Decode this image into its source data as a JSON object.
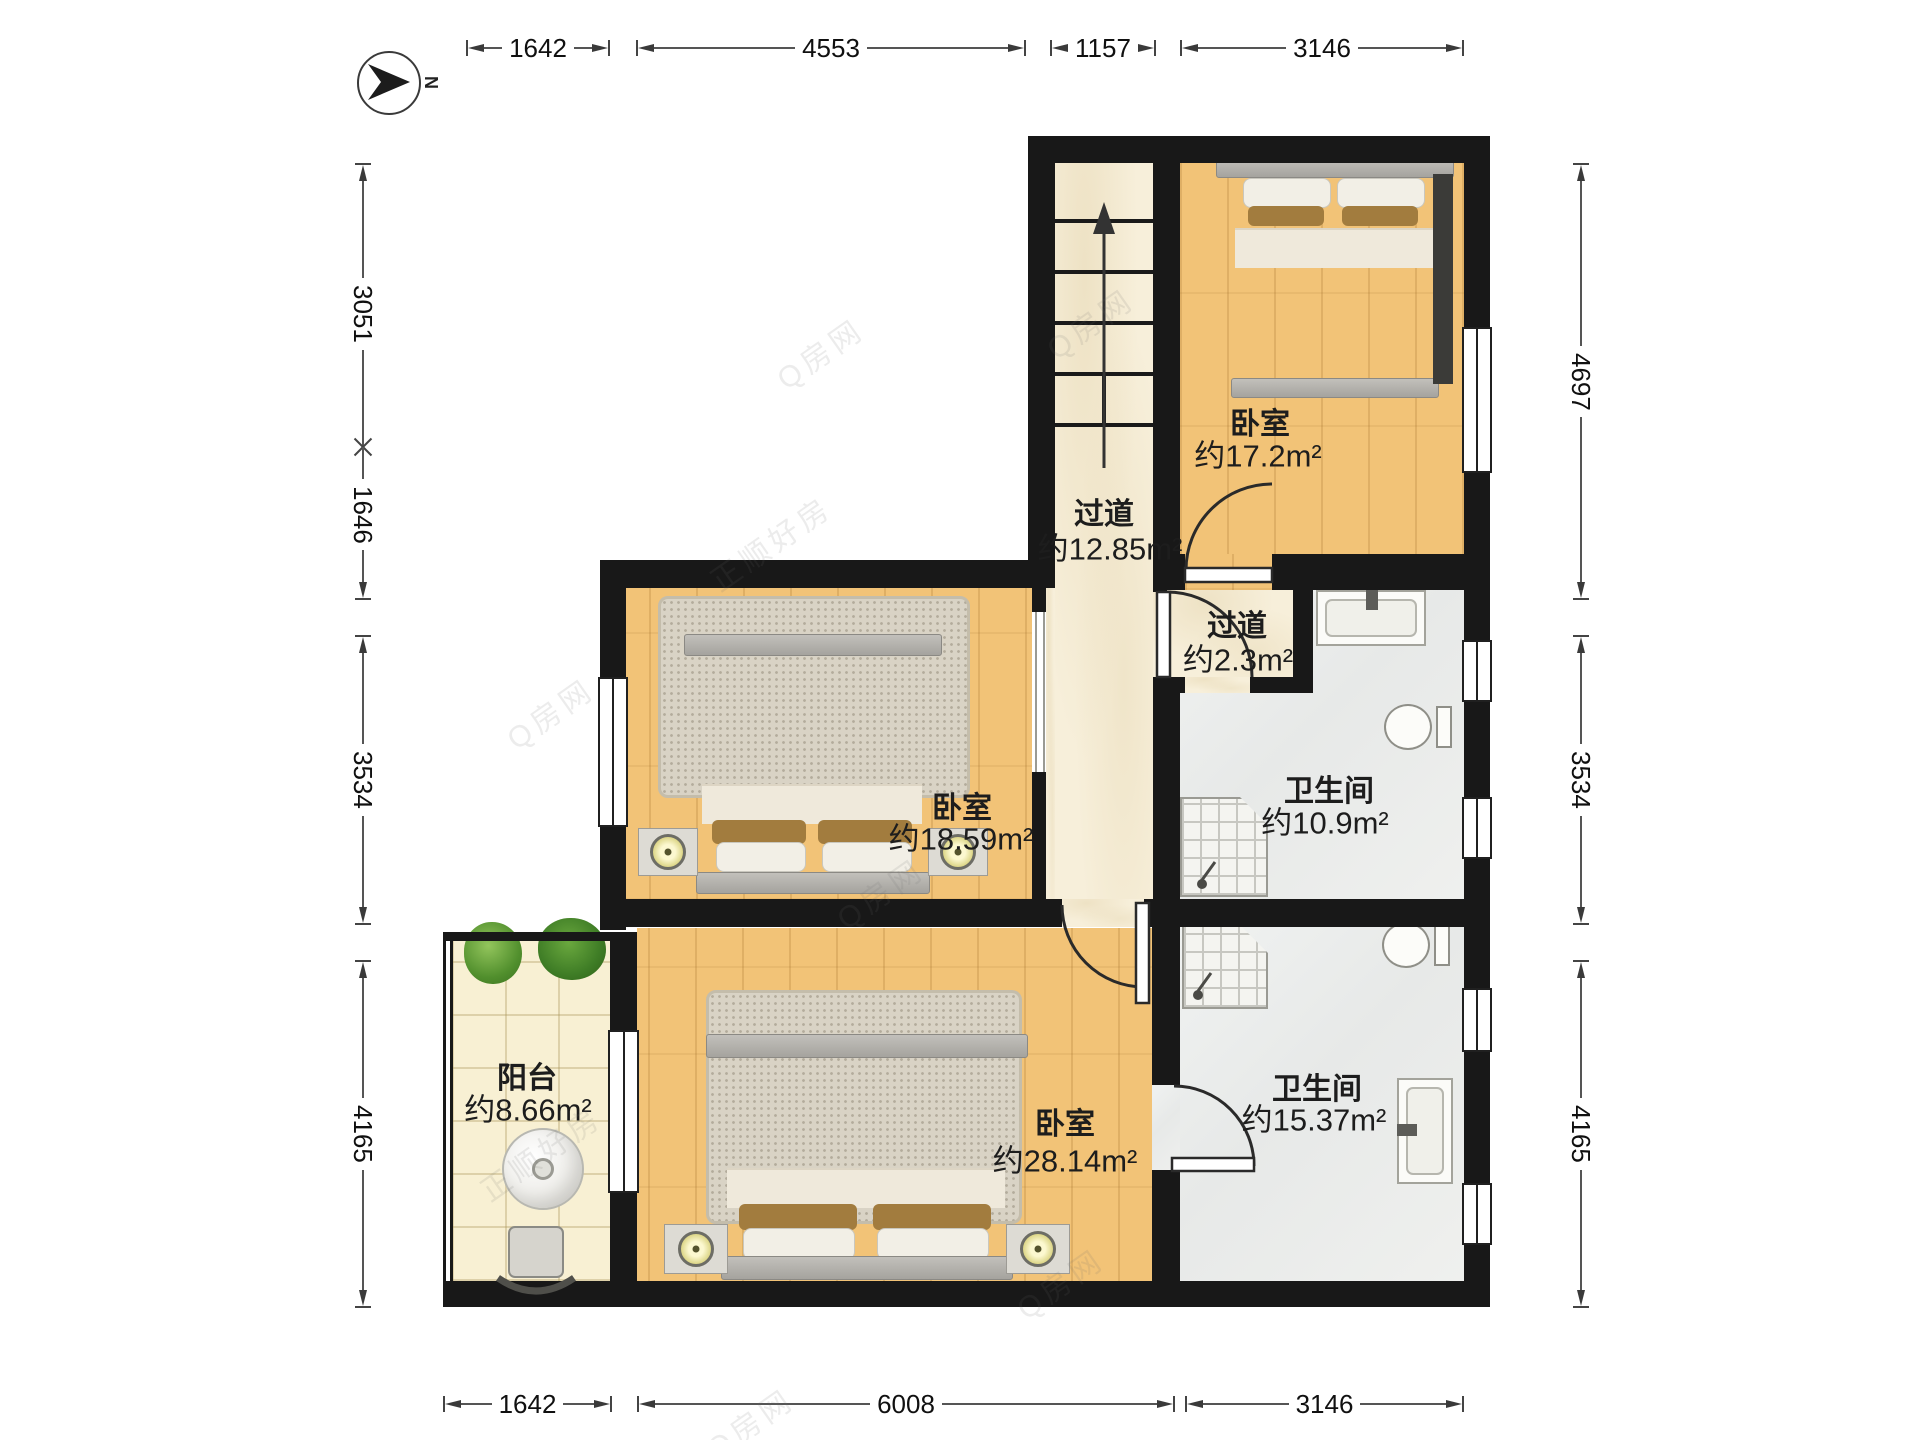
{
  "compass": {
    "north_label": "N"
  },
  "rooms": {
    "bedroom_tr": {
      "name": "卧室",
      "area": "约17.2m²"
    },
    "corridor_main": {
      "name": "过道",
      "area": "约12.85m²"
    },
    "corridor_small": {
      "name": "过道",
      "area": "约2.3m²"
    },
    "bath_upper": {
      "name": "卫生间",
      "area": "约10.9m²"
    },
    "bedroom_mid": {
      "name": "卧室",
      "area": "约18.59m²"
    },
    "bedroom_lg": {
      "name": "卧室",
      "area": "约28.14m²"
    },
    "balcony": {
      "name": "阳台",
      "area": "约8.66m²"
    },
    "bath_lower": {
      "name": "卫生间",
      "area": "约15.37m²"
    }
  },
  "dimensions": {
    "top": [
      {
        "label": "1642"
      },
      {
        "label": "4553"
      },
      {
        "label": "1157"
      },
      {
        "label": "3146"
      }
    ],
    "left": [
      {
        "label": "3051"
      },
      {
        "label": "1646"
      },
      {
        "label": "3534"
      },
      {
        "label": "4165"
      }
    ],
    "right": [
      {
        "label": "4697"
      },
      {
        "label": "3534"
      },
      {
        "label": "4165"
      }
    ],
    "bottom": [
      {
        "label": "1642"
      },
      {
        "label": "6008"
      },
      {
        "label": "3146"
      }
    ]
  },
  "watermark": {
    "brand": "Q房网",
    "agency": "正顺好房"
  },
  "colors": {
    "wall": "#181818",
    "floor_wood": "#f2c377",
    "floor_marble_cream": "#f7efda",
    "floor_bath_grey": "#eaecec",
    "floor_balcony_tile": "#f8f0d3",
    "rug": "#d9d3c5",
    "duvet_brown": "#8a6e4c",
    "dimension_text": "#101010"
  }
}
